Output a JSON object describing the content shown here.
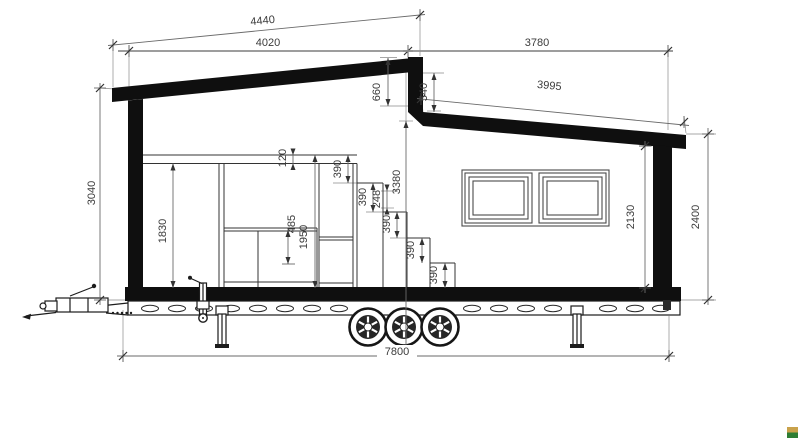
{
  "drawing": {
    "type": "tiny-house-trailer-cross-section",
    "dims": {
      "roof_upper": "4440",
      "plate_left": "4020",
      "plate_right": "3780",
      "roof_lower": "3995",
      "clerestory_outer": "660",
      "clerestory_inner": "540",
      "height_left": "3040",
      "height_center": "3380",
      "loft_floor": "120",
      "room_left": "1830",
      "counter": "485",
      "stair_tower": "1950",
      "steps": [
        "390",
        "390",
        "248",
        "390",
        "390",
        "390"
      ],
      "height_right_inner": "2130",
      "height_right_outer": "2400",
      "total_length": "7800"
    },
    "logo": {
      "top_color": "#c9a24b",
      "bottom_color": "#2e7d33"
    }
  }
}
